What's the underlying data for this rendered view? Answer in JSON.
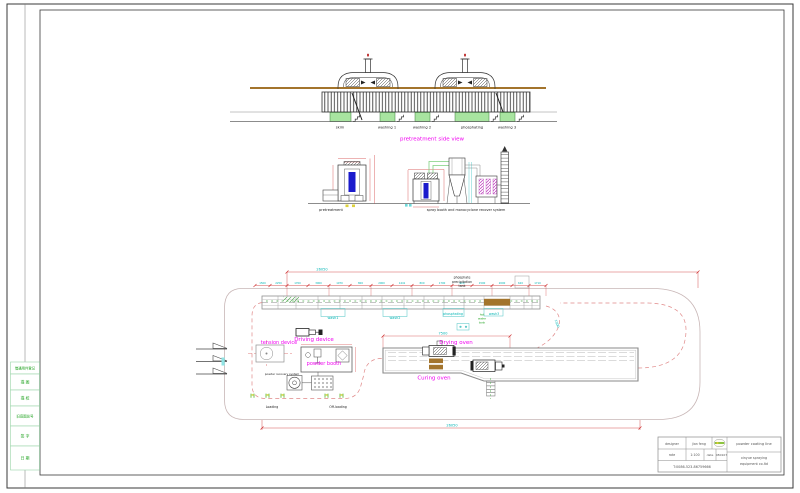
{
  "side_view": {
    "title": "pretreatment side view",
    "stations": [
      "skim",
      "washing 1",
      "washing 2",
      "phosphating",
      "washing 3"
    ]
  },
  "front_view": {
    "pretreatment_label": "pretreatment",
    "booth_label": "spray booth and monocyclone recover system"
  },
  "plan_view": {
    "phosphate_note": [
      "phosphate",
      "precipitation",
      "tank"
    ],
    "hot_water_note": [
      "hot",
      "water",
      "tank"
    ],
    "tension_device": "tension device",
    "driving_device": "Driving device",
    "powder_booth": "powder booth",
    "powder_recovery": "powder recovery system",
    "drying_oven": "Drying oven",
    "curing_oven": "Curing oven",
    "loading": "Loading",
    "offloading": "Off-loading",
    "wash1": "wash1",
    "wash2": "wash2",
    "phosphating": "phosphating",
    "wash3": "wash3"
  },
  "dimensions": {
    "total_top": "26050",
    "total_bottom": "26050",
    "oven_length": "7500",
    "slope_dim": "1500",
    "chain": [
      "1500",
      "2250",
      "1700",
      "3000",
      "1970",
      "800",
      "2000",
      "1441",
      "800",
      "1700",
      "620",
      "1500",
      "2000",
      "620",
      "1710"
    ]
  },
  "title_block": {
    "designer_label": "designer",
    "designer_name": "jian feng",
    "rate_label": "rate",
    "rate_value": "1:100",
    "date_label": "date",
    "date_value": "080107",
    "phone": "T:0086-523-86759666",
    "project": "powder coating line",
    "company": [
      "xinyue spraying",
      "equipment co.ltd"
    ]
  },
  "margin_table": {
    "rows": [
      "借通用件登记",
      "描 图",
      "描 校",
      "旧底图总号",
      "签 字",
      "日 期"
    ]
  },
  "colors": {
    "magenta": "#f000f0",
    "cyan": "#00b4b4",
    "dim_red": "#cc2626",
    "rail_brown": "#a3742c",
    "tank_green": "#a8e4a0",
    "note_green": "#1ea21e"
  }
}
